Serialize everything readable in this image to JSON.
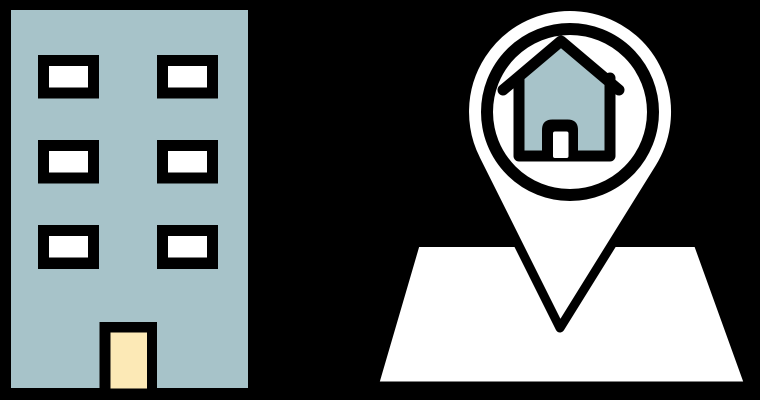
{
  "scene": {
    "background": "#000000",
    "description": "Flat illustration: an apartment building beside a map location pin containing a house",
    "colors": {
      "outline": "#000000",
      "surface_blue": "#a7c3c9",
      "door_cream": "#fce9b6",
      "white": "#ffffff"
    },
    "building": {
      "window_count": 6,
      "window_rows": 3,
      "window_cols": 2,
      "has_door": true
    },
    "map_pin": {
      "pin_contains": "house",
      "base": "map"
    }
  }
}
